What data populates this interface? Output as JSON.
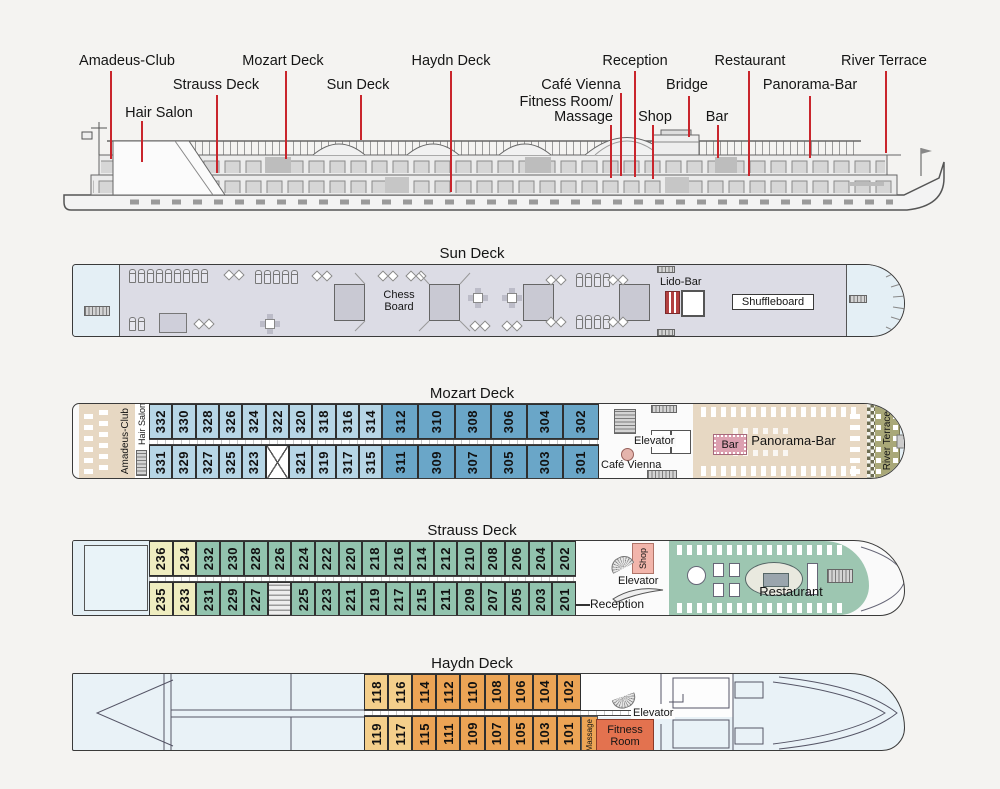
{
  "overview": {
    "labels": [
      {
        "id": "amadeus-club",
        "text": "Amadeus-Club"
      },
      {
        "id": "mozart-deck",
        "text": "Mozart Deck"
      },
      {
        "id": "haydn-deck",
        "text": "Haydn Deck"
      },
      {
        "id": "reception",
        "text": "Reception"
      },
      {
        "id": "restaurant",
        "text": "Restaurant"
      },
      {
        "id": "river-terrace",
        "text": "River Terrace"
      },
      {
        "id": "strauss-deck",
        "text": "Strauss Deck"
      },
      {
        "id": "sun-deck",
        "text": "Sun Deck"
      },
      {
        "id": "cafe-vienna",
        "text": "Café Vienna"
      },
      {
        "id": "bridge",
        "text": "Bridge"
      },
      {
        "id": "panorama-bar",
        "text": "Panorama-Bar"
      },
      {
        "id": "hair-salon",
        "text": "Hair Salon"
      },
      {
        "id": "fitness-room-massage",
        "line1": "Fitness Room/",
        "line2": "Massage"
      },
      {
        "id": "shop",
        "text": "Shop"
      },
      {
        "id": "bar",
        "text": "Bar"
      }
    ]
  },
  "sun_deck": {
    "title": "Sun Deck",
    "chess_board": "Chess Board",
    "lido_bar": "Lido-Bar",
    "shuffleboard": "Shuffleboard"
  },
  "mozart_deck": {
    "title": "Mozart Deck",
    "amadeus_club": "Amadeus-Club",
    "hair_salon": "Hair Salon",
    "elevator": "Elevator",
    "cafe_vienna": "Café Vienna",
    "bar": "Bar",
    "panorama_bar": "Panorama-Bar",
    "river_terrace": "River Terrace",
    "cabins_top": [
      {
        "n": "332",
        "t": "bl"
      },
      {
        "n": "330",
        "t": "bl"
      },
      {
        "n": "328",
        "t": "bl"
      },
      {
        "n": "326",
        "t": "bl"
      },
      {
        "n": "324",
        "t": "bl"
      },
      {
        "n": "322",
        "t": "bl"
      },
      {
        "n": "320",
        "t": "bl"
      },
      {
        "n": "318",
        "t": "bl"
      },
      {
        "n": "316",
        "t": "bl"
      },
      {
        "n": "314",
        "t": "bl"
      },
      {
        "n": "312",
        "t": "bd"
      },
      {
        "n": "310",
        "t": "bd"
      },
      {
        "n": "308",
        "t": "bd"
      },
      {
        "n": "306",
        "t": "bd"
      },
      {
        "n": "304",
        "t": "bd"
      },
      {
        "n": "302",
        "t": "bd"
      }
    ],
    "cabins_bottom": [
      {
        "n": "331",
        "t": "bl"
      },
      {
        "n": "329",
        "t": "bl"
      },
      {
        "n": "327",
        "t": "bl"
      },
      {
        "n": "325",
        "t": "bl"
      },
      {
        "n": "323",
        "t": "bl"
      },
      {
        "t": "x"
      },
      {
        "n": "321",
        "t": "bl"
      },
      {
        "n": "319",
        "t": "bl"
      },
      {
        "n": "317",
        "t": "bl"
      },
      {
        "n": "315",
        "t": "bl"
      },
      {
        "n": "311",
        "t": "bd"
      },
      {
        "n": "309",
        "t": "bd"
      },
      {
        "n": "307",
        "t": "bd"
      },
      {
        "n": "305",
        "t": "bd"
      },
      {
        "n": "303",
        "t": "bd"
      },
      {
        "n": "301",
        "t": "bd"
      }
    ]
  },
  "strauss_deck": {
    "title": "Strauss Deck",
    "shop": "Shop",
    "elevator": "Elevator",
    "reception": "Reception",
    "restaurant": "Restaurant",
    "cabins_top": [
      {
        "n": "236",
        "t": "yl"
      },
      {
        "n": "234",
        "t": "yl"
      },
      {
        "n": "232",
        "t": "gr"
      },
      {
        "n": "230",
        "t": "gr"
      },
      {
        "n": "228",
        "t": "gr"
      },
      {
        "n": "226",
        "t": "gr"
      },
      {
        "n": "224",
        "t": "gr"
      },
      {
        "n": "222",
        "t": "gr"
      },
      {
        "n": "220",
        "t": "gr"
      },
      {
        "n": "218",
        "t": "gr"
      },
      {
        "n": "216",
        "t": "gr"
      },
      {
        "n": "214",
        "t": "gr"
      },
      {
        "n": "212",
        "t": "gr"
      },
      {
        "n": "210",
        "t": "gr"
      },
      {
        "n": "208",
        "t": "gr"
      },
      {
        "n": "206",
        "t": "gr"
      },
      {
        "n": "204",
        "t": "gr"
      },
      {
        "n": "202",
        "t": "gr"
      }
    ],
    "cabins_bottom": [
      {
        "n": "235",
        "t": "yl"
      },
      {
        "n": "233",
        "t": "yl"
      },
      {
        "n": "231",
        "t": "gr"
      },
      {
        "n": "229",
        "t": "gr"
      },
      {
        "n": "227",
        "t": "gr"
      },
      {
        "t": "st"
      },
      {
        "n": "225",
        "t": "gr"
      },
      {
        "n": "223",
        "t": "gr"
      },
      {
        "n": "221",
        "t": "gr"
      },
      {
        "n": "219",
        "t": "gr"
      },
      {
        "n": "217",
        "t": "gr"
      },
      {
        "n": "215",
        "t": "gr"
      },
      {
        "n": "211",
        "t": "gr"
      },
      {
        "n": "209",
        "t": "gr"
      },
      {
        "n": "207",
        "t": "gr"
      },
      {
        "n": "205",
        "t": "gr"
      },
      {
        "n": "203",
        "t": "gr"
      },
      {
        "n": "201",
        "t": "gr"
      }
    ]
  },
  "haydn_deck": {
    "title": "Haydn Deck",
    "elevator": "Elevator",
    "massage": "Massage",
    "fitness_room": "Fitness Room",
    "cabins_top": [
      {
        "n": "118",
        "t": "ol"
      },
      {
        "n": "116",
        "t": "ol"
      },
      {
        "n": "114",
        "t": "or"
      },
      {
        "n": "112",
        "t": "or"
      },
      {
        "n": "110",
        "t": "or"
      },
      {
        "n": "108",
        "t": "or"
      },
      {
        "n": "106",
        "t": "or"
      },
      {
        "n": "104",
        "t": "or"
      },
      {
        "n": "102",
        "t": "or"
      }
    ],
    "cabins_bottom": [
      {
        "n": "119",
        "t": "ol"
      },
      {
        "n": "117",
        "t": "ol"
      },
      {
        "n": "115",
        "t": "or"
      },
      {
        "n": "111",
        "t": "or"
      },
      {
        "n": "109",
        "t": "or"
      },
      {
        "n": "107",
        "t": "or"
      },
      {
        "n": "105",
        "t": "or"
      },
      {
        "n": "103",
        "t": "or"
      },
      {
        "n": "101",
        "t": "or"
      }
    ]
  },
  "colors": {
    "leader_red": "#c9252c",
    "cabin_blue_light": "#b7d6e6",
    "cabin_blue_dark": "#6aa6c8",
    "cabin_yellow": "#efedc0",
    "cabin_green": "#92c3ae",
    "cabin_orange_light": "#f4cf8b",
    "cabin_orange": "#eca455",
    "club_tan": "#e7d8c3",
    "terrace_olive": "#a9a878",
    "shop_pink": "#f2b5ab",
    "bar_pink": "#dca0b0",
    "fitness_red": "#e3724f",
    "restaurant_green": "#9dc6b1",
    "sun_deck_fill": "#dcdce5",
    "hull_fill": "#e4eff5"
  }
}
